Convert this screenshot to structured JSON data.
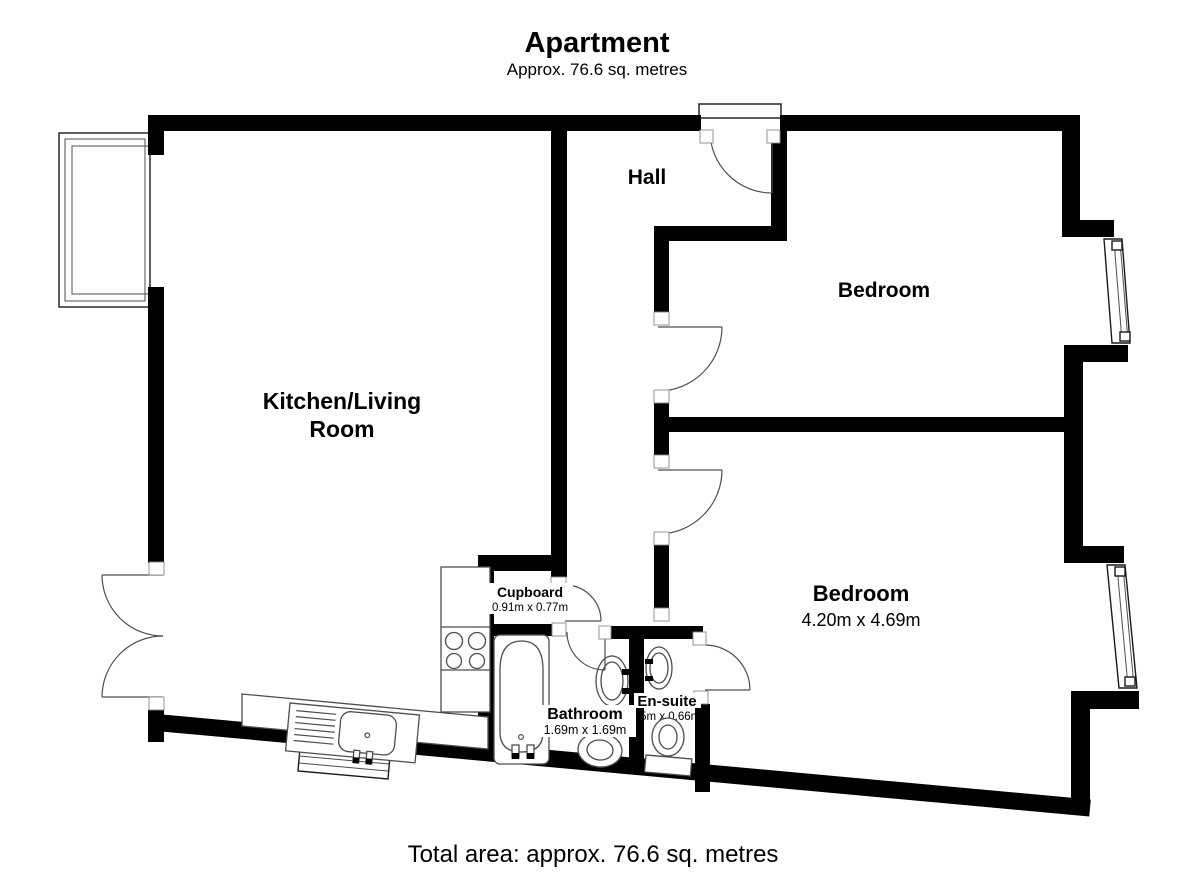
{
  "header": {
    "title": "Apartment",
    "subtitle": "Approx. 76.6 sq. metres"
  },
  "footer": {
    "total_area": "Total area: approx. 76.6 sq. metres"
  },
  "rooms": {
    "hall": {
      "label": "Hall"
    },
    "bedroom_top": {
      "label": "Bedroom"
    },
    "kitchen_living": {
      "line1": "Kitchen/Living",
      "line2": "Room"
    },
    "bedroom_bottom": {
      "label": "Bedroom",
      "dims": "4.20m x 4.69m"
    },
    "cupboard": {
      "label": "Cupboard",
      "dims": "0.91m x 0.77m"
    },
    "bathroom": {
      "label": "Bathroom",
      "dims": "1.69m x 1.69m"
    },
    "ensuite": {
      "label": "En-suite",
      "dims": "75m x 0.66m"
    }
  },
  "colors": {
    "wall": "#000000",
    "fixture_line": "#4d4d4d",
    "background": "#ffffff"
  }
}
